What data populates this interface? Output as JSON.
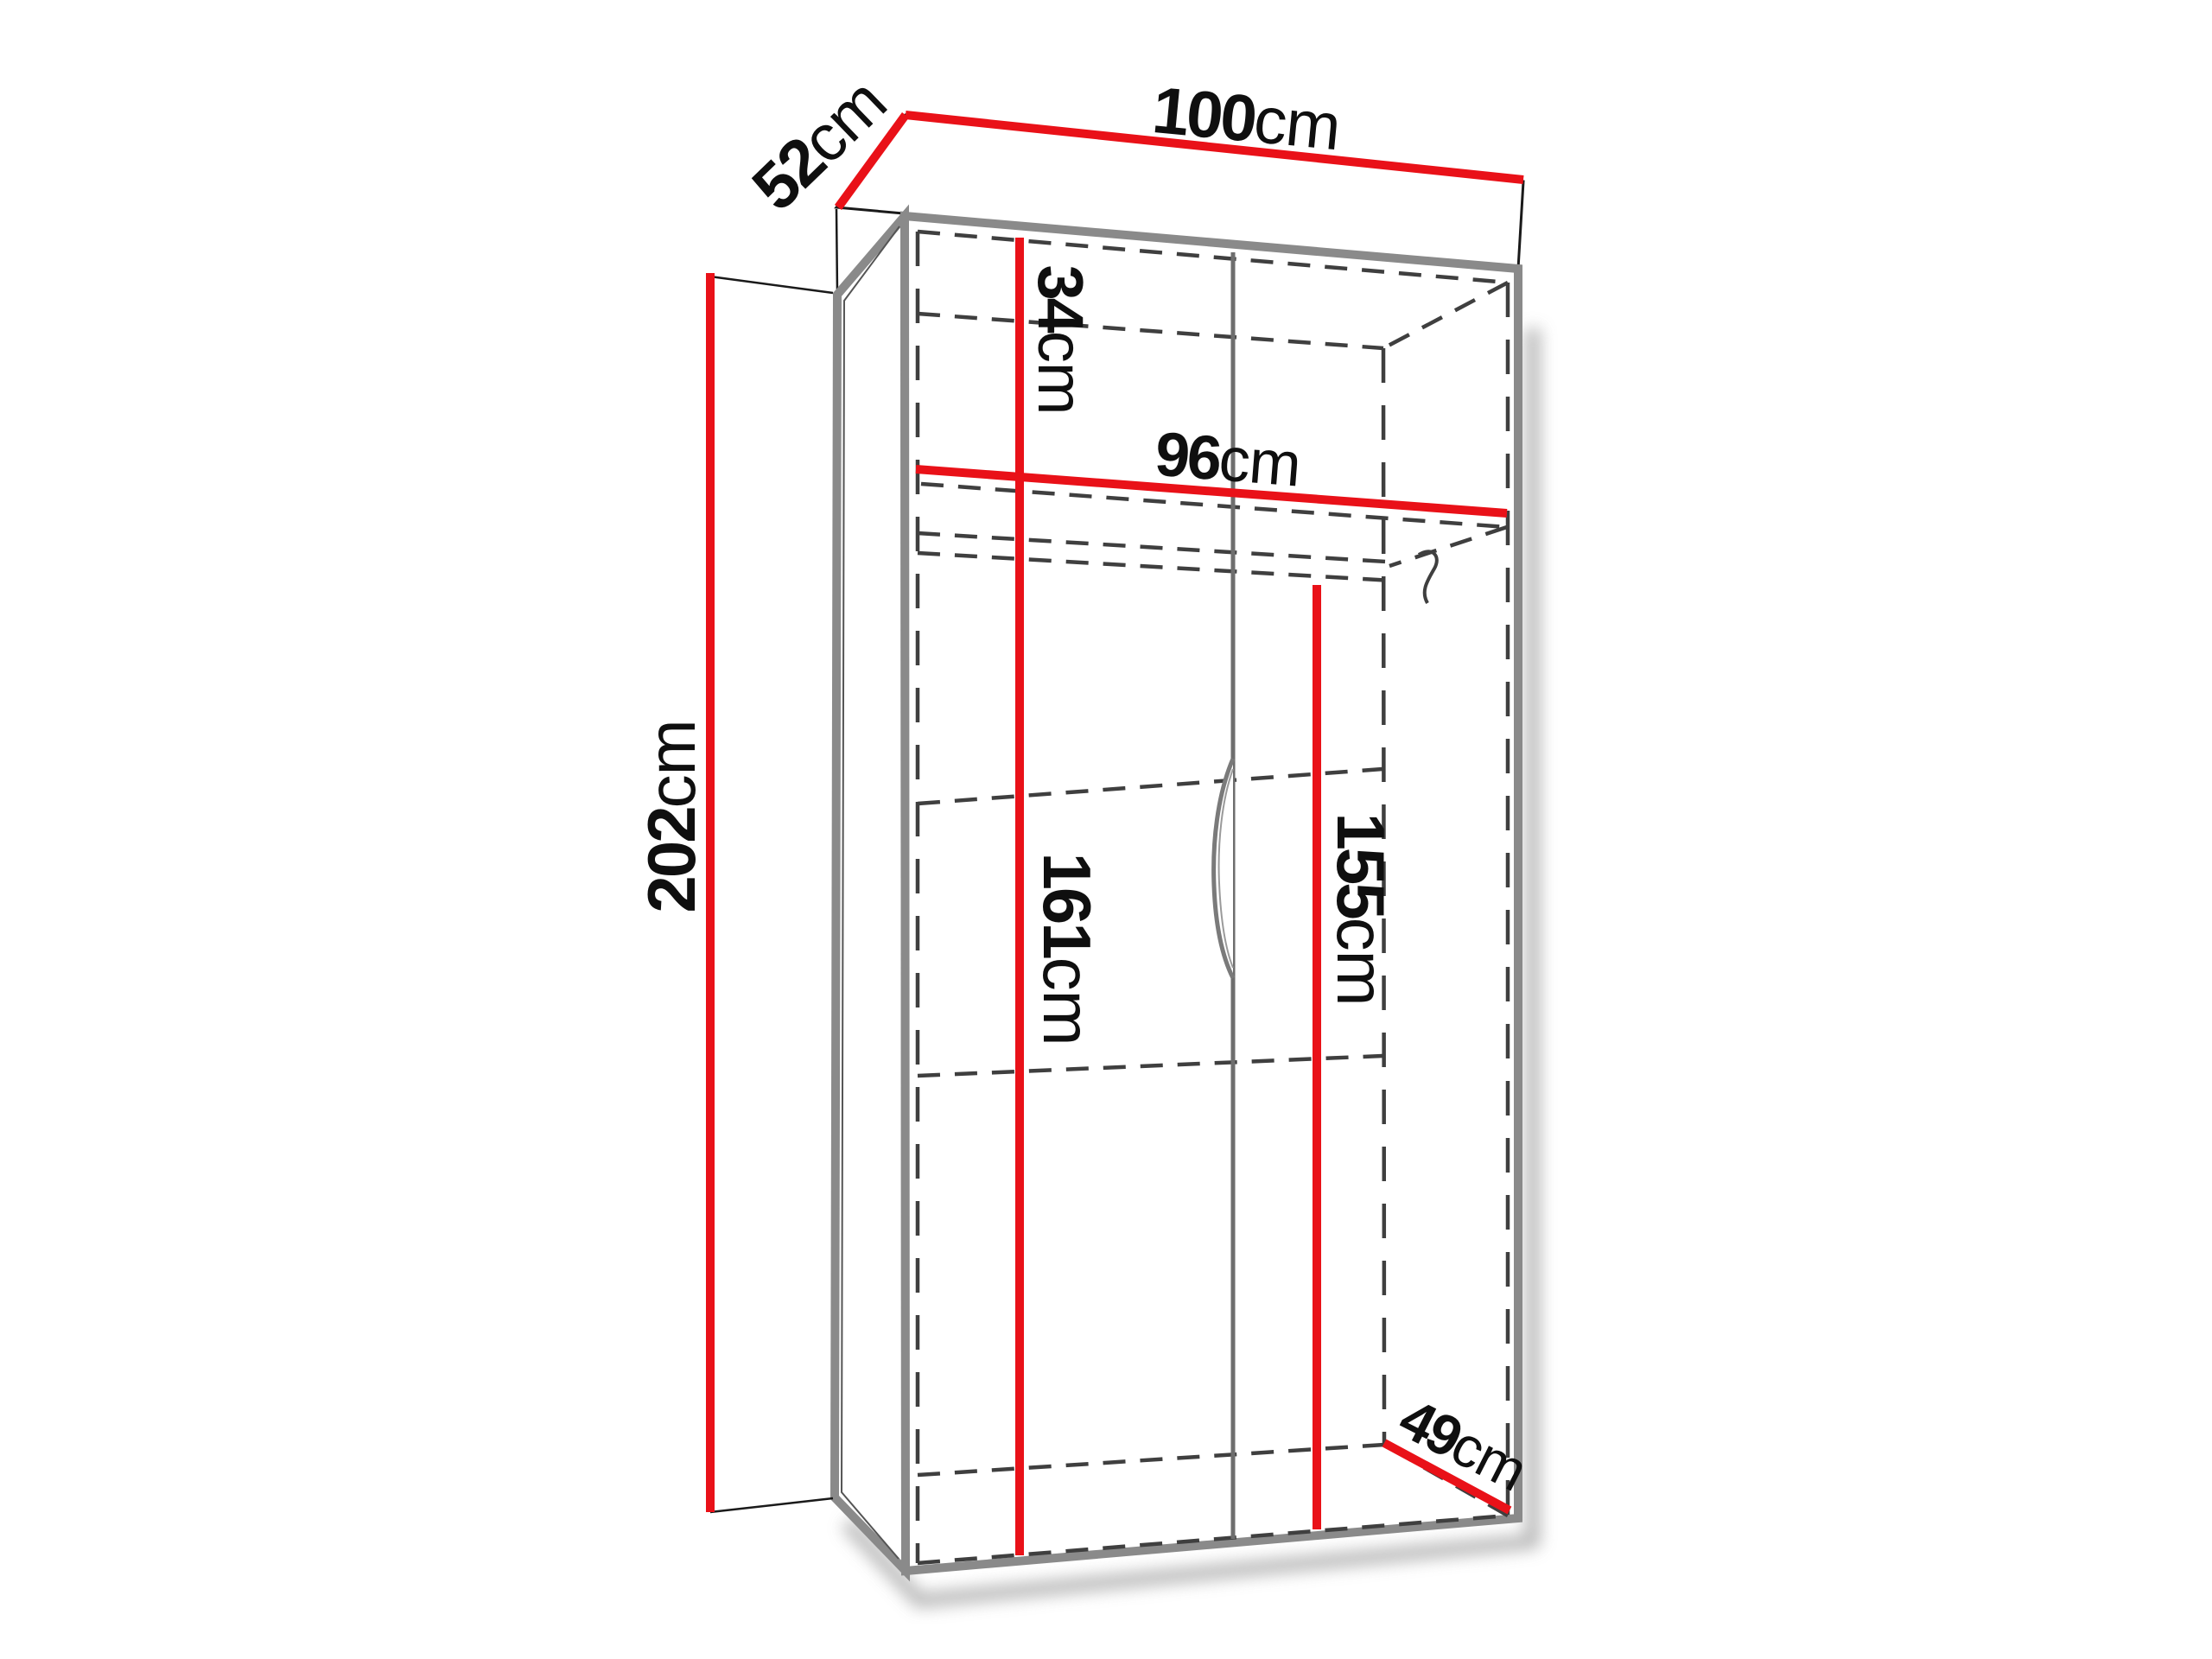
{
  "figure": {
    "type": "furniture dimension diagram",
    "subject": "two-door wardrobe with top shelf and clothes rail, drawn in perspective with red dimension lines"
  },
  "dims": {
    "width": {
      "value": "100",
      "unit": "cm",
      "meaning": "overall exterior width (top back edge)"
    },
    "depth_top": {
      "value": "52",
      "unit": "cm",
      "meaning": "overall exterior depth (top left edge)"
    },
    "height": {
      "value": "202",
      "unit": "cm",
      "meaning": "overall exterior height (left side)"
    },
    "top_compartment": {
      "value": "34",
      "unit": "cm",
      "meaning": "height of top compartment above shelf"
    },
    "inner_width": {
      "value": "96",
      "unit": "cm",
      "meaning": "interior width (shelf)"
    },
    "inner_height_left": {
      "value": "161",
      "unit": "cm",
      "meaning": "interior height below shelf (left)"
    },
    "inner_height_right": {
      "value": "155",
      "unit": "cm",
      "meaning": "interior height below clothes rail (right)"
    },
    "inner_depth": {
      "value": "49",
      "unit": "cm",
      "meaning": "interior depth (bottom right)"
    }
  },
  "colors": {
    "dimension_line": "#e91118",
    "panel_edge_gray": "#8a8a8a",
    "hidden_edge_dashed": "#3f3f3f",
    "outline_black": "#1a1a1a",
    "text": "#0f0f0f",
    "background": "#ffffff",
    "shadow": "#b0b0b0"
  }
}
